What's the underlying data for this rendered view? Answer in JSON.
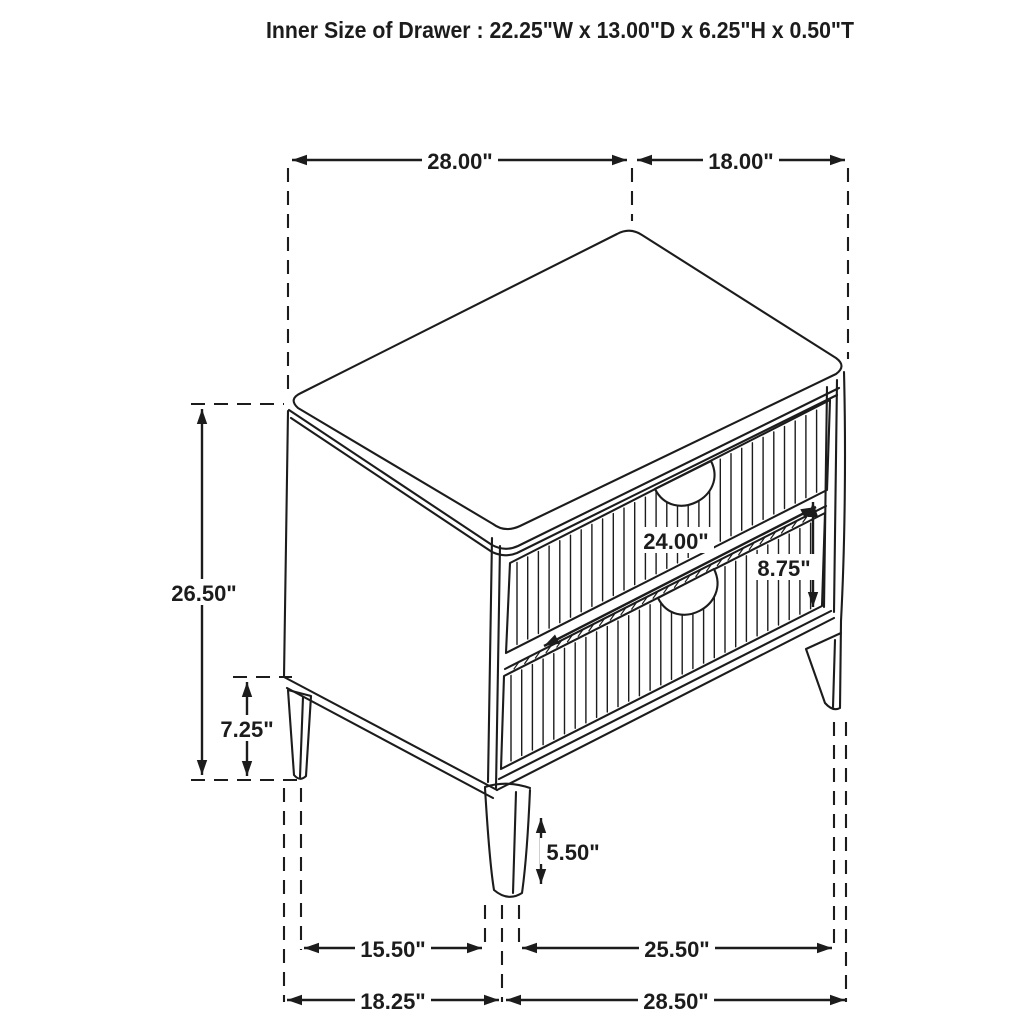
{
  "title": "Inner Size of Drawer : 22.25\"W x 13.00\"D x 6.25\"H x 0.50\"T",
  "dims": {
    "top_width": "28.00\"",
    "top_depth": "18.00\"",
    "overall_height": "26.50\"",
    "side_leg_clearance": "7.25\"",
    "drawer_width": "24.00\"",
    "drawer_front_height": "8.75\"",
    "front_leg_height": "5.50\"",
    "base_inner_side": "15.50\"",
    "base_inner_front": "25.50\"",
    "base_outer_side": "18.25\"",
    "base_outer_front": "28.50\""
  },
  "colors": {
    "ink": "#1c1c1c",
    "background": "#ffffff"
  }
}
